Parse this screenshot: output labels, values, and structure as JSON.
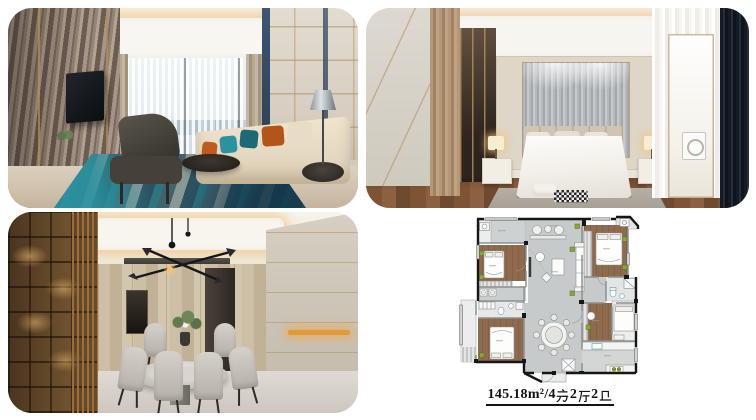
{
  "page": {
    "background_color": "#ffffff"
  },
  "gallery": {
    "panels": [
      {
        "name": "living-room-photo"
      },
      {
        "name": "bedroom-photo"
      },
      {
        "name": "dining-room-photo"
      },
      {
        "name": "floor-plan"
      }
    ]
  },
  "floor_plan_caption": {
    "full_text": "145.18㎡/4房2厅2卫",
    "area_number": "145.18",
    "area_unit": "m²",
    "separator": "/",
    "bedroom_count": "4",
    "bedroom_word": "房",
    "hall_count": "2",
    "hall_word": "厅",
    "bath_count": "2",
    "bath_word": "卫"
  },
  "floor_plan_colors": {
    "wood_floor": "#8f6b4e",
    "tile_floor": "#c7caca",
    "bath_floor": "#e6e8e8",
    "wall_black": "#161616",
    "wall_gray": "#8d8f90",
    "ac_marker_green": "#8ba634"
  },
  "photo_accent_colors": {
    "teal_pillow": "#2a93a0",
    "orange_pillow": "#c05a1e",
    "brass_trim": "#b08d57",
    "warm_cove_light": "#f2b258",
    "navy_curtain": "#1c2430",
    "rug_teal": "#2d5a66",
    "wood_tone": "#8c6141"
  }
}
